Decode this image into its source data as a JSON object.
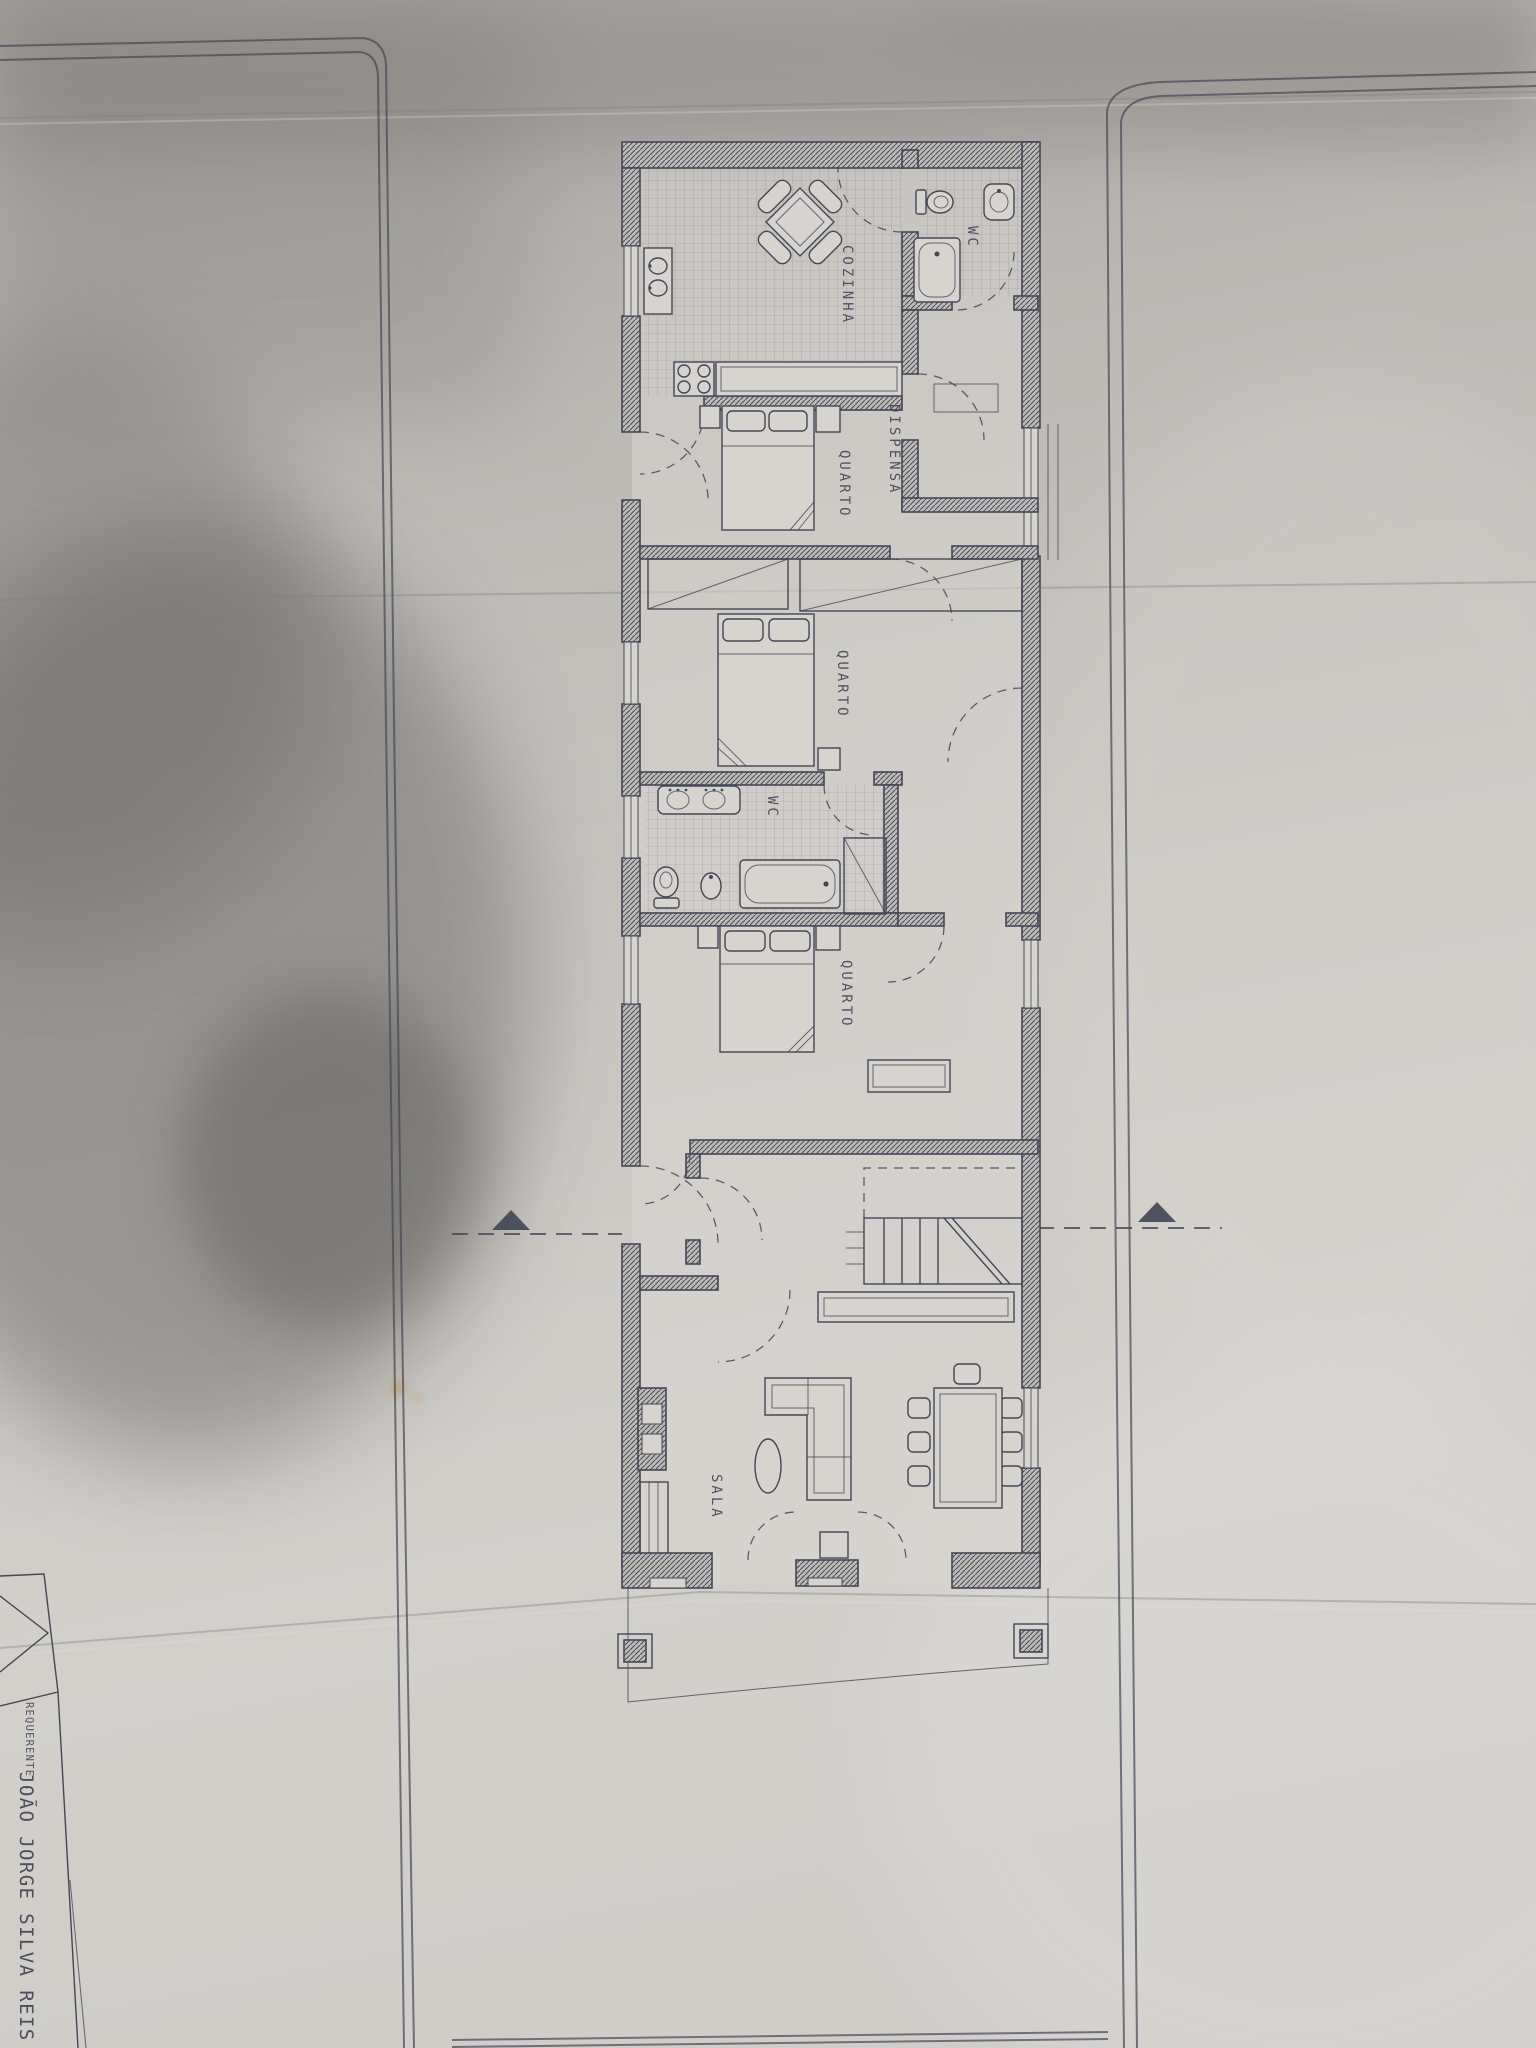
{
  "document": {
    "rooms": {
      "kitchen": "COZINHA",
      "wc_top": "WC",
      "pantry": "DISPENSA",
      "bedroom_1": "QUARTO",
      "bedroom_2": "QUARTO",
      "wc_main": "WC",
      "bedroom_3": "QUARTO",
      "living": "SALA"
    },
    "title_block": {
      "field_label": "REQUERENTE :",
      "name": "JOÃO JORGE SILVA REIS"
    },
    "colors": {
      "ink": "#434756",
      "room": "#d7d4cf",
      "paper_light": "#d8d5d1",
      "paper_mid": "#c6c3bf",
      "paper_dark": "#9b9894",
      "shadow": "#4e4b49",
      "stain": "#b98f3e"
    }
  }
}
